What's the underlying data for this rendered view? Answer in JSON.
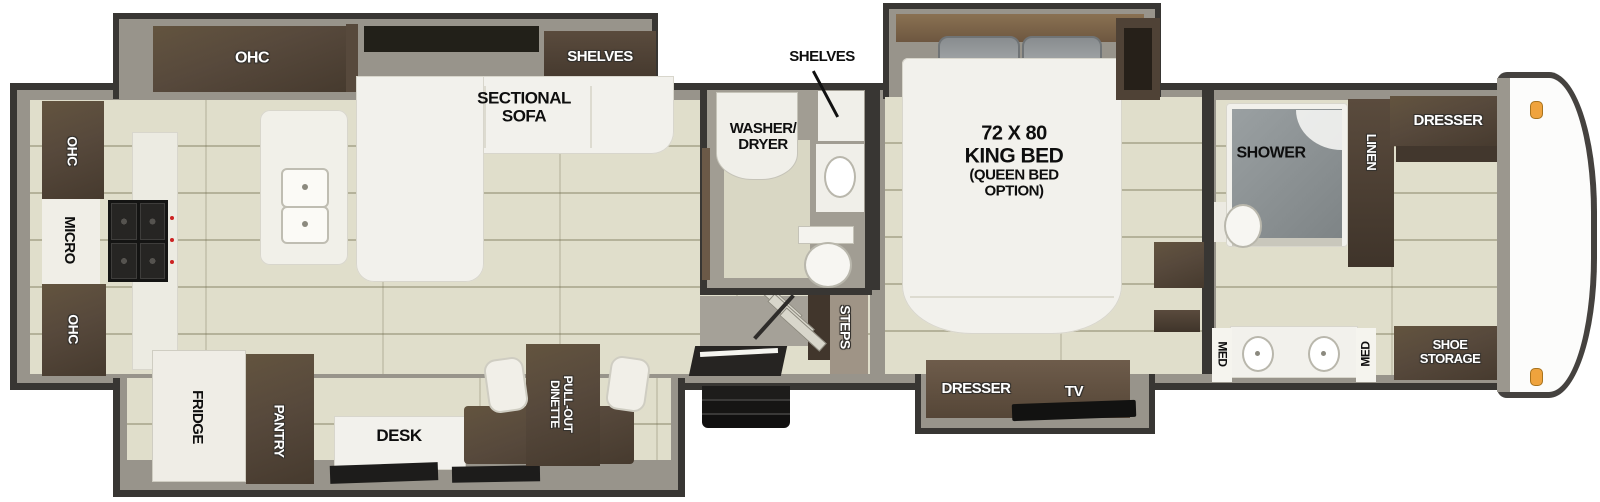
{
  "title": "Fifth wheel RV floor plan",
  "colors": {
    "wall": "#383633",
    "wall_inner": "#98948b",
    "floor": "#e0decb",
    "cabinet_brown": "#57493c",
    "fixture_white": "#f2f1ec",
    "appliance_black": "#1d1c1b",
    "marker_light": "#efa33d"
  },
  "rooms": {
    "kitchen": {
      "ohc_slide": "OHC",
      "ohc_upper": "OHC",
      "micro": "MICRO",
      "ohc_lower": "OHC",
      "fridge": "FRIDGE",
      "pantry": "PANTRY",
      "desk": "DESK",
      "dinette": [
        "PULL-OUT",
        "DINETTE"
      ]
    },
    "living": {
      "shelves": "SHELVES",
      "sofa": [
        "SECTIONAL",
        "SOFA"
      ]
    },
    "half_bath": {
      "shelves": "SHELVES",
      "washer_dryer": [
        "WASHER/",
        "DRYER"
      ],
      "steps": "STEPS"
    },
    "bedroom": {
      "bed": [
        "72 X 80",
        "KING BED",
        "(QUEEN BED",
        "OPTION)"
      ],
      "dresser": "DRESSER",
      "tv": "TV"
    },
    "bathroom": {
      "shower": "SHOWER",
      "linen": "LINEN",
      "dresser": "DRESSER",
      "med_left": "MED",
      "med_right": "MED",
      "shoe_storage": [
        "SHOE",
        "STORAGE"
      ]
    }
  }
}
